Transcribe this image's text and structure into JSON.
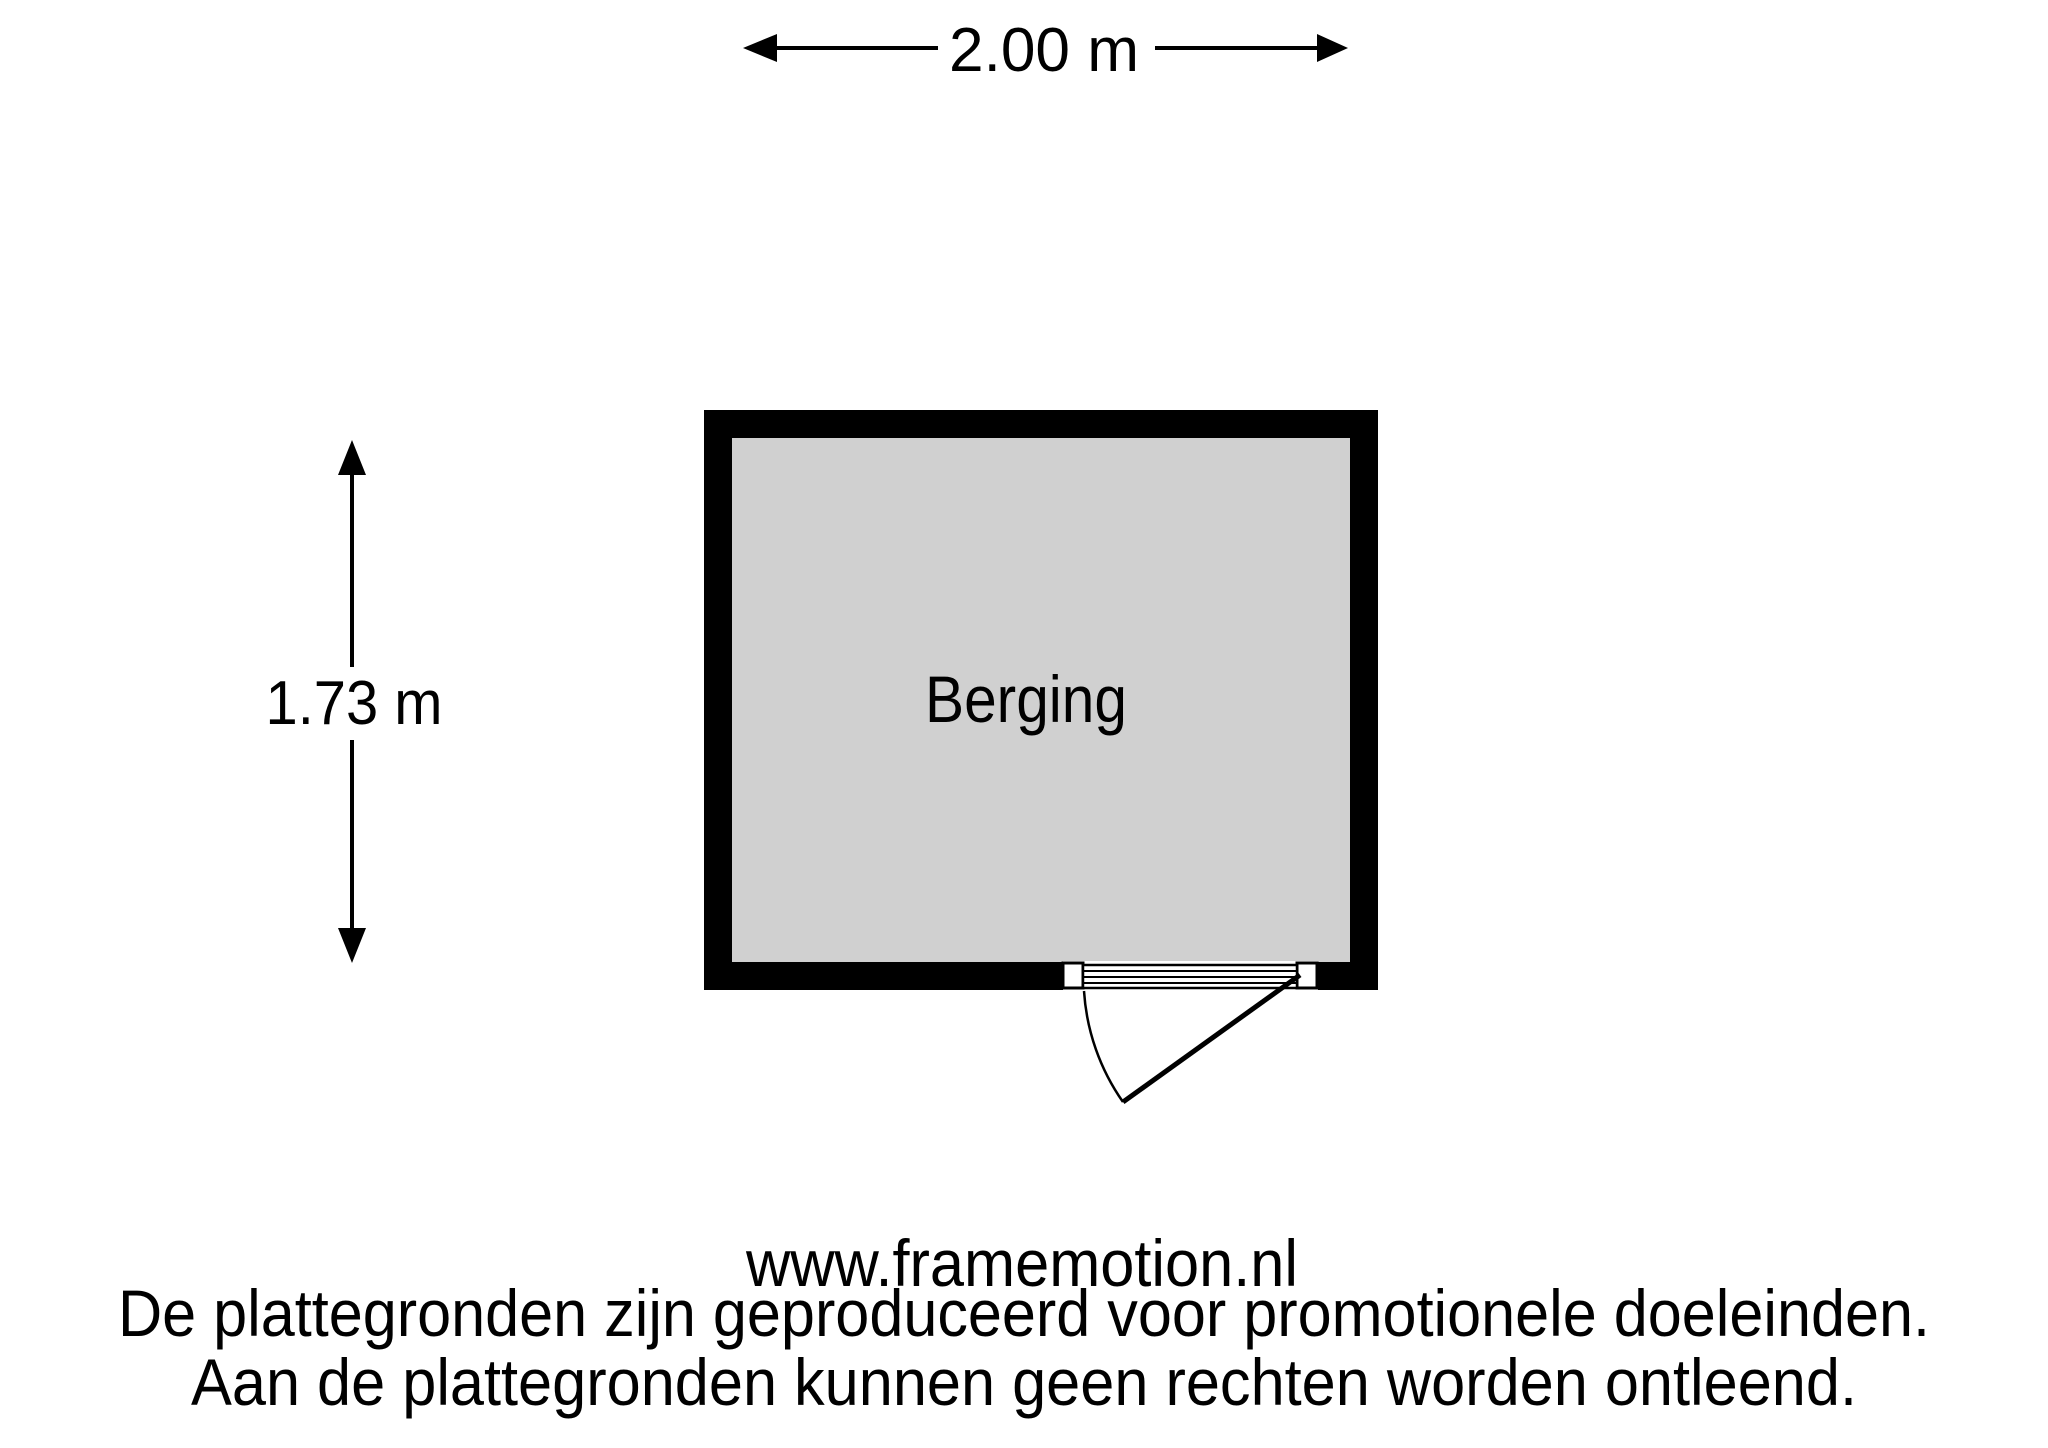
{
  "dimensions": {
    "width_label": "2.00 m",
    "height_label": "1.73 m"
  },
  "room": {
    "label": "Berging"
  },
  "colors": {
    "room_fill": "#d0d0d0",
    "wall": "#000000",
    "line": "#000000"
  },
  "footer": {
    "website": "www.framemotion.nl",
    "disclaimer_line1": "De plattegronden zijn geproduceerd voor promotionele doeleinden.",
    "disclaimer_line2": "Aan de plattegronden kunnen geen rechten worden ontleend."
  }
}
